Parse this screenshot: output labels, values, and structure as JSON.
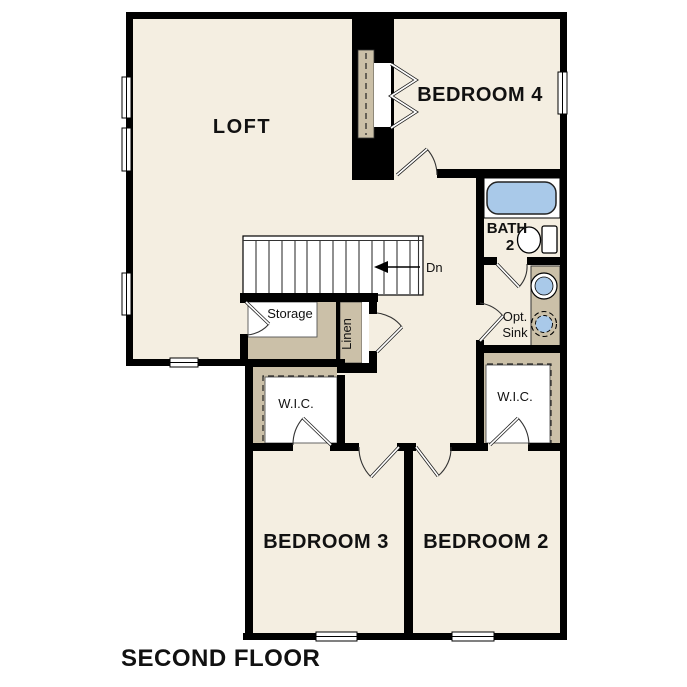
{
  "plan": {
    "title": "SECOND FLOOR",
    "rooms": {
      "loft": "LOFT",
      "bedroom4": "BEDROOM 4",
      "bedroom3": "BEDROOM 3",
      "bedroom2": "BEDROOM 2",
      "bath_line1": "BATH",
      "bath_line2": "2",
      "wic_left": "W.I.C.",
      "wic_right": "W.I.C.",
      "storage": "Storage",
      "linen": "Linen"
    },
    "annotations": {
      "stair_direction": "Dn",
      "opt_sink_line1": "Opt.",
      "opt_sink_line2": "Sink"
    },
    "colors": {
      "wall": "#000000",
      "floor": "#f4eee1",
      "shelf": "#cbc0a8",
      "fixture_blue": "#a9c9e9",
      "background": "#ffffff",
      "text": "#111111"
    }
  }
}
